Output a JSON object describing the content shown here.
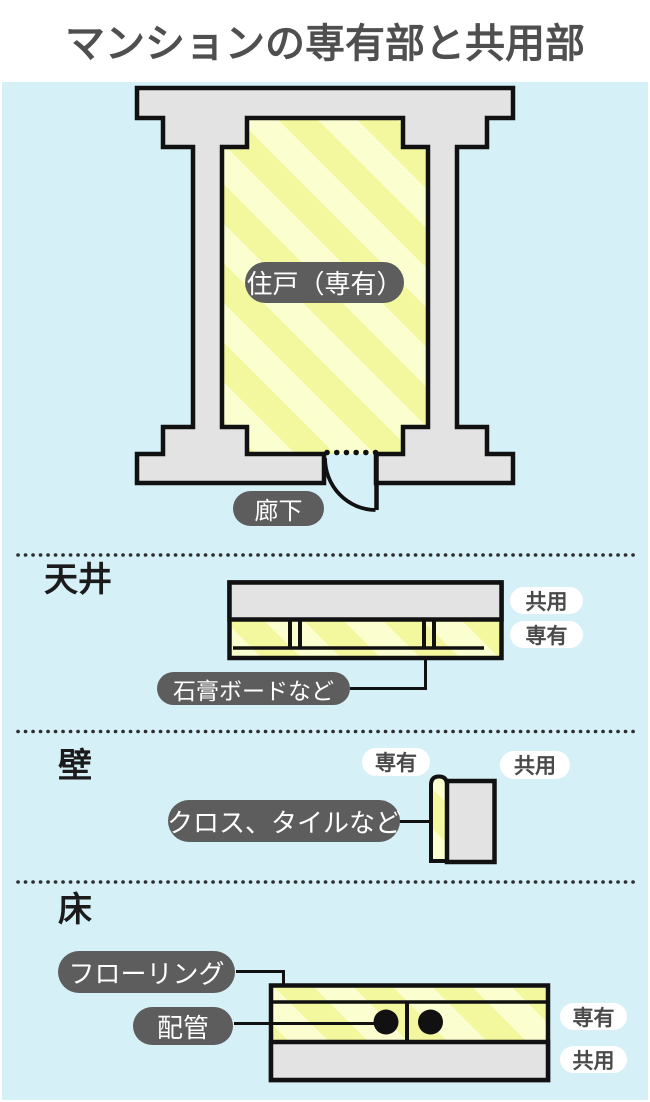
{
  "title": "マンションの専有部と共用部",
  "plan": {
    "unit_label": "住戸（専有）",
    "corridor_label": "廊下"
  },
  "ceiling": {
    "heading": "天井",
    "shared_label": "共用",
    "private_label": "専有",
    "callout": "石膏ボードなど"
  },
  "wall": {
    "heading": "壁",
    "private_label": "専有",
    "shared_label": "共用",
    "callout": "クロス、タイルなど"
  },
  "floor": {
    "heading": "床",
    "callout_flooring": "フローリング",
    "callout_piping": "配管",
    "private_label": "専有",
    "shared_label": "共用"
  },
  "colors": {
    "background_blue": "#d6f0f8",
    "wall_gray": "#e3e3e3",
    "stripe_light": "#fbffcf",
    "stripe_bright": "#f3f79d",
    "outline_black": "#111111",
    "dark_pill_gray": "#5d5d5d",
    "white_pill_text": "#4a4a4a",
    "title_text": "#4f4f4f"
  }
}
